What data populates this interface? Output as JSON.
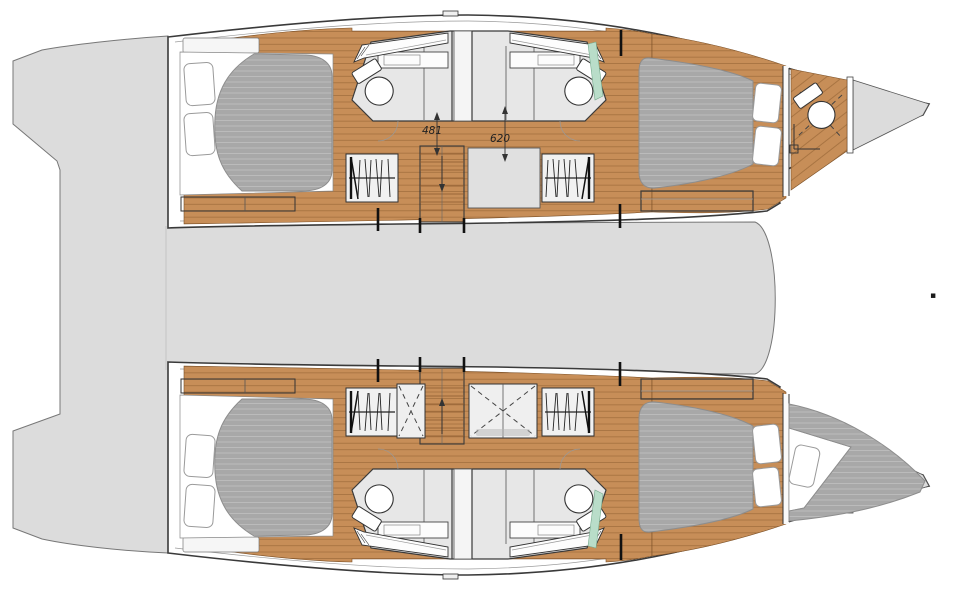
{
  "plan": {
    "type": "yacht-deck-floor-plan",
    "vessel_type": "catamaran",
    "view": "top-down",
    "hulls": [
      "port",
      "starboard"
    ],
    "dimensions": [
      {
        "label": "481",
        "orientation": "vertical"
      },
      {
        "label": "620",
        "orientation": "vertical"
      }
    ],
    "features": [
      "aft-cabin-double-berth",
      "fore-cabin-double-berth",
      "bathroom",
      "shower-cubicle",
      "toilet",
      "vanity-sink",
      "wardrobe-hanging-locker",
      "companionway-stairs",
      "bow-head-compartment",
      "bow-berth",
      "swim-platform",
      "bridgedeck-cockpit"
    ],
    "marker_glyph": "▪",
    "colors": {
      "deck": "#dcdcdc",
      "wood": "#c78e58",
      "woodline": "#9c6a39",
      "mattress": "#a8a8a8",
      "mint": "#b9ddc9",
      "outline": "#333333",
      "bg": "#ffffff"
    }
  }
}
